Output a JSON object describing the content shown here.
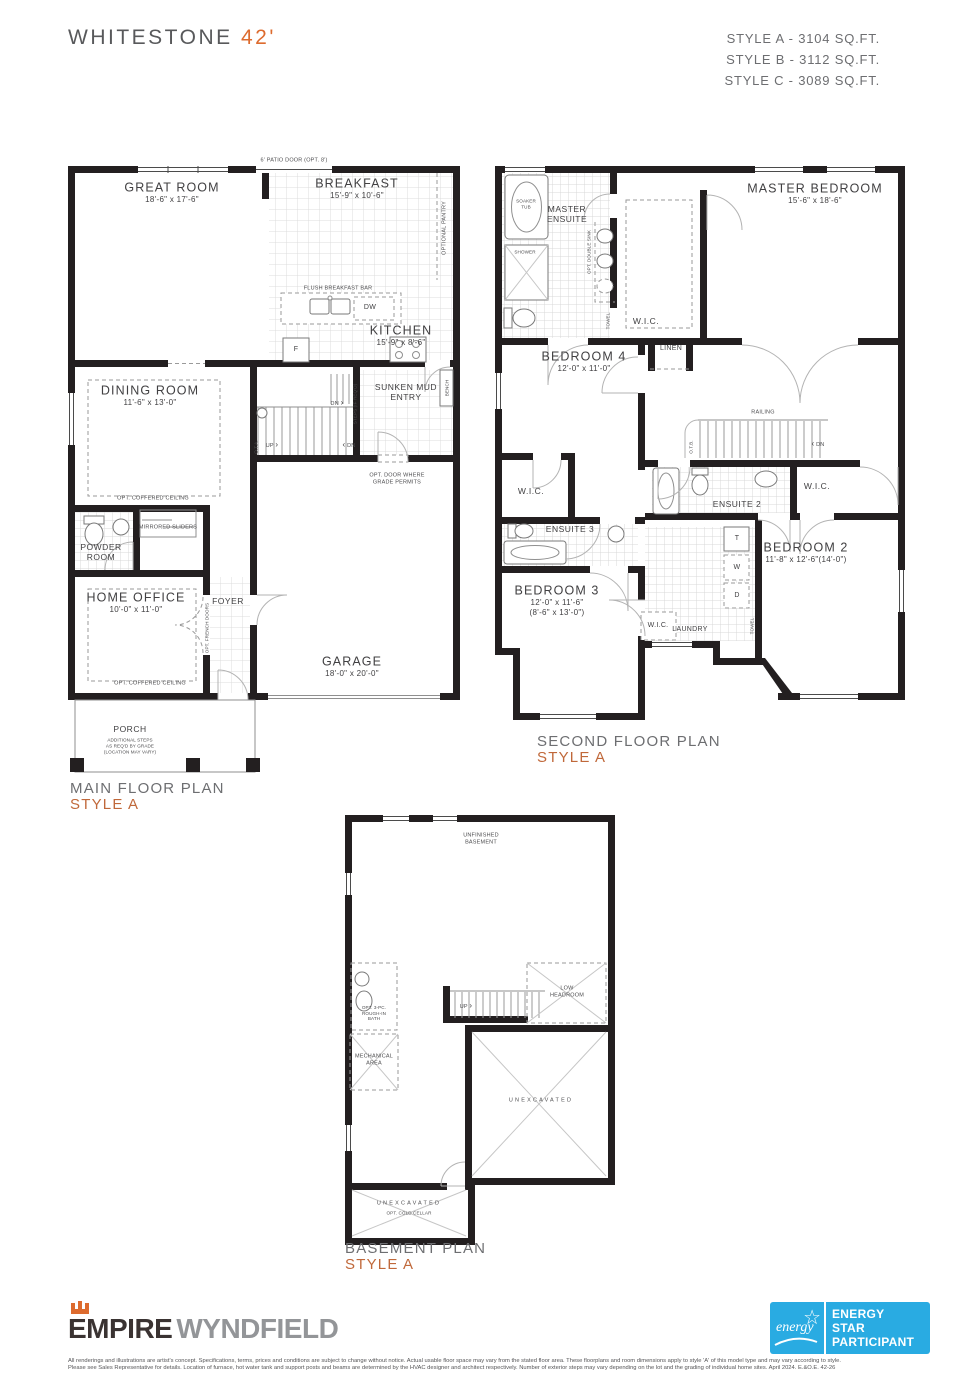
{
  "header": {
    "title": "WHITESTONE",
    "title_accent": "42'",
    "styles": [
      "STYLE A - 3104 SQ.FT.",
      "STYLE B - 3112 SQ.FT.",
      "STYLE C - 3089 SQ.FT."
    ]
  },
  "icons": {
    "arrow_left": "‹",
    "arrow_right": "›"
  },
  "plans": {
    "main": {
      "caption": "MAIN FLOOR PLAN",
      "style": "STYLE A",
      "rooms": {
        "great_room": {
          "name": "GREAT ROOM",
          "dims": "18'-6\" x 17'-6\""
        },
        "breakfast": {
          "name": "BREAKFAST",
          "dims": "15'-9\" x 10'-6\""
        },
        "kitchen": {
          "name": "KITCHEN",
          "dims": "15'-9\" x 8'-6\""
        },
        "dining": {
          "name": "DINING ROOM",
          "dims": "11'-6\" x 13'-0\""
        },
        "home_office": {
          "name": "HOME OFFICE",
          "dims": "10'-0\" x 11'-0\""
        },
        "garage": {
          "name": "GARAGE",
          "dims": "18'-0\" x 20'-0\""
        },
        "powder": "POWDER ROOM",
        "foyer": "FOYER",
        "mud": "SUNKEN MUD ENTRY",
        "porch": {
          "name": "PORCH",
          "note1": "ADDITIONAL STEPS",
          "note2": "AS REQ'D BY GRADE",
          "note3": "(LOCATION MAY VARY)"
        }
      },
      "annotations": {
        "patio_door": "6' PATIO DOOR (OPT. 8')",
        "pantry": "OPTIONAL PANTRY",
        "breakfast_bar": "FLUSH BREAKFAST BAR",
        "dw": "DW",
        "fridge": "F",
        "coffered": "OPT. COFFERED CEILING",
        "mirrored": "MIRRORED SLIDERS",
        "french": "OPT. FRENCH DOORS",
        "steps": "STEPS (IF REQ'D)",
        "dn": "DN",
        "up": "UP",
        "ota": "O.T.A.",
        "bench": "BENCH",
        "opt_door": "OPT. DOOR WHERE GRADE PERMITS"
      }
    },
    "second": {
      "caption": "SECOND FLOOR PLAN",
      "style": "STYLE A",
      "rooms": {
        "master": {
          "name": "MASTER BEDROOM",
          "dims": "15'-6\" x 18'-6\""
        },
        "bedroom4": {
          "name": "BEDROOM 4",
          "dims": "12'-0\" x 11'-0\""
        },
        "bedroom2": {
          "name": "BEDROOM 2",
          "dims": "11'-8\" x 12'-6\"(14'-0\")"
        },
        "bedroom3": {
          "name": "BEDROOM 3",
          "dims": "12'-0\" x 11'-6\"",
          "dims_alt": "(8'-6\" x 13'-0\")"
        },
        "master_ensuite": "MASTER ENSUITE",
        "ensuite3": "ENSUITE 3",
        "ensuite2": "ENSUITE 2",
        "laundry": "LAUNDRY",
        "wic": "W.I.C.",
        "linen": "LINEN"
      },
      "annotations": {
        "soaker": "SOAKER TUB",
        "shower": "SHOWER",
        "double_sink": "OPT. DOUBLE SINK",
        "towel": "TOWEL",
        "railing": "RAILING",
        "otb": "O.T.B.",
        "dn": "DN",
        "t": "T",
        "w": "W",
        "d": "D"
      }
    },
    "basement": {
      "caption": "BASEMENT PLAN",
      "style": "STYLE A",
      "labels": {
        "unfinished": "UNFINISHED BASEMENT",
        "low_headroom": "LOW HEADROOM",
        "up": "UP",
        "rough_in": "OPT. 3-PC. ROUGH-IN BATH",
        "mechanical": "MECHANICAL AREA",
        "unexcavated": "UNEXCAVATED",
        "cold_cellar": "OPT. COLD CELLAR"
      }
    }
  },
  "footer": {
    "brand_primary": "EMPIRE",
    "brand_secondary": "WYNDFIELD",
    "energy_badge": {
      "script": "energy",
      "line1": "ENERGY",
      "line2": "STAR",
      "line3": "PARTICIPANT"
    },
    "disclaimer1": "All renderings and illustrations are artist's concept. Specifications, terms, prices and conditions are subject to change without notice. Actual usable floor space may vary from the stated floor area. These floorplans and room dimensions apply to style 'A' of this model type and may vary according to style.",
    "disclaimer2": "Please see Sales Representative for details. Location of furnace, hot water tank and support posts and beams are determined by the HVAC designer and architect respectively. Number of exterior steps may vary depending on the lot and the grading of individual home sites. April 2024. E.&O.E. 42-26"
  },
  "colors": {
    "wall": "#231f20",
    "accent": "#c0683a",
    "accent_bright": "#dd6b2e",
    "text_gray": "#6d6e71",
    "energy_blue": "#29abe2"
  }
}
